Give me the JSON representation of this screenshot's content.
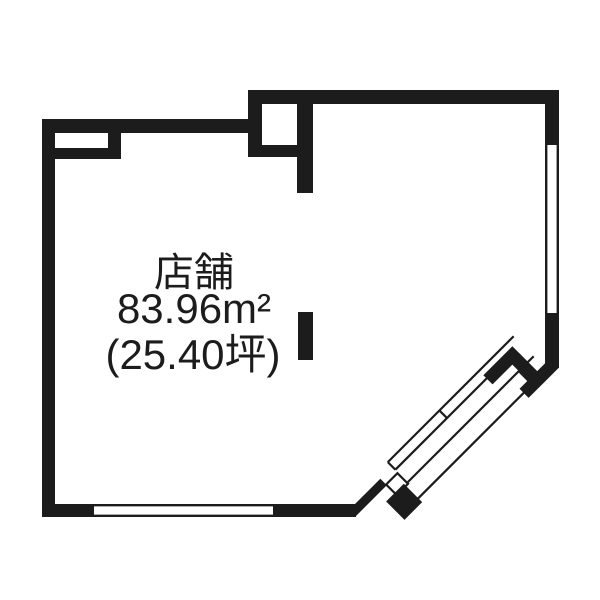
{
  "floorplan": {
    "room": {
      "label": "店舗",
      "area_m2": "83.96m²",
      "area_tsubo": "(25.40坪)"
    },
    "features": {
      "right_wall": "window-double-line",
      "bottom_wall": "window-double-line",
      "corner": "diagonal-sliding-door"
    },
    "colors": {
      "wall": "#1c1c1c",
      "background": "#ffffff"
    }
  }
}
